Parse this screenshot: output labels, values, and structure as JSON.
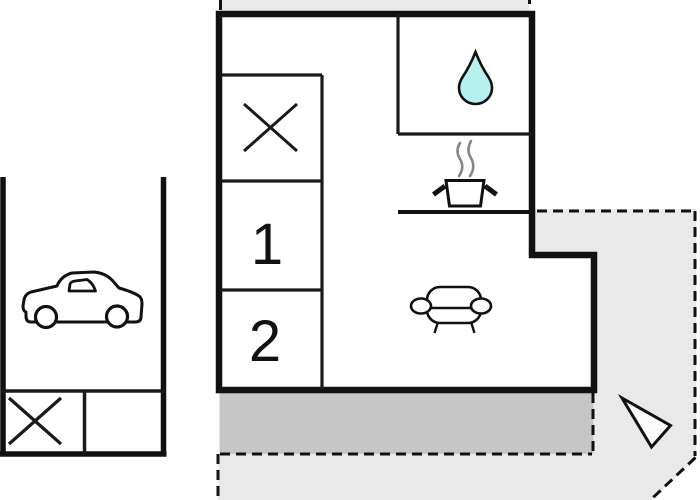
{
  "floorplan": {
    "building": {
      "room1_label": "1",
      "room2_label": "2"
    },
    "colors": {
      "outline": "#111111",
      "plot_fill": "#e9e9e9",
      "terrace_fill": "#c6c6c6",
      "water_drop_fill": "#b5f2ef",
      "steam": "#868686",
      "paper": "#ffffff"
    },
    "icons": [
      "water-drop-icon",
      "cooking-pot-icon",
      "steam-icon",
      "sofa-icon",
      "cross-icon",
      "car-icon",
      "north-arrow-icon"
    ]
  }
}
